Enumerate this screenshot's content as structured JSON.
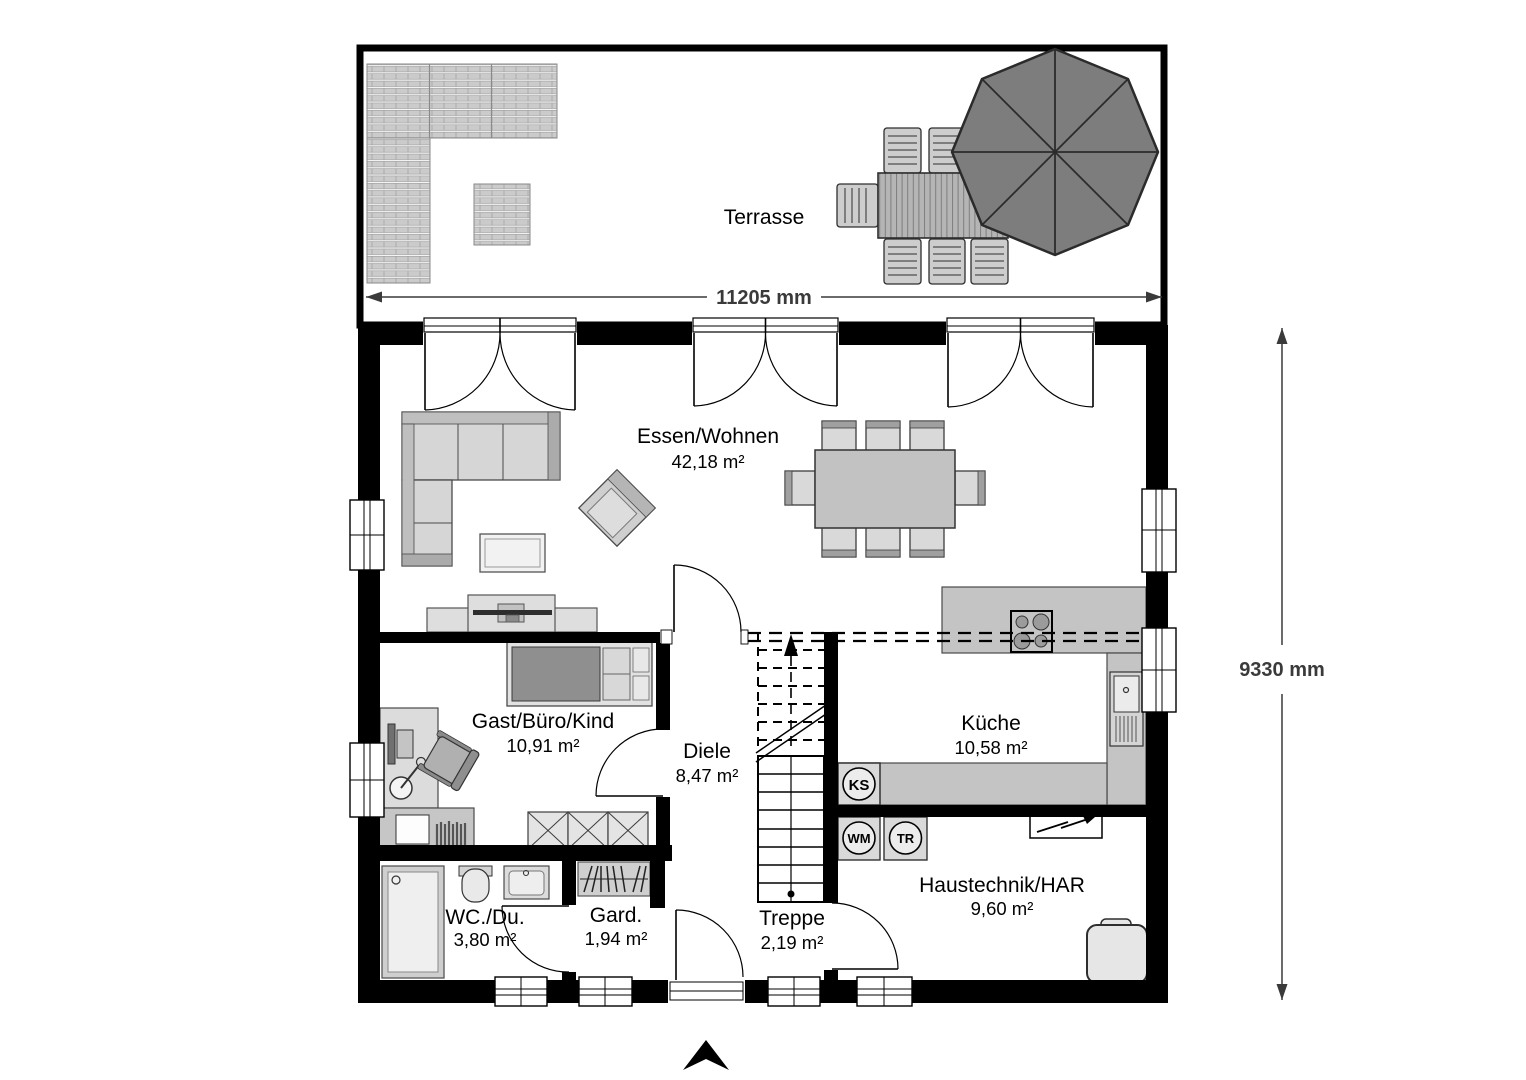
{
  "terrace": {
    "label": "Terrasse"
  },
  "dimensions": {
    "width_label": "11205 mm",
    "height_label": "9330 mm"
  },
  "rooms": {
    "essen_wohnen": {
      "name": "Essen/Wohnen",
      "area": "42,18 m²"
    },
    "gast_buero_kind": {
      "name": "Gast/Büro/Kind",
      "area": "10,91 m²"
    },
    "diele": {
      "name": "Diele",
      "area": "8,47 m²"
    },
    "kueche": {
      "name": "Küche",
      "area": "10,58 m²"
    },
    "wc_du": {
      "name": "WC./Du.",
      "area": "3,80 m²"
    },
    "garderobe": {
      "name": "Gard.",
      "area": "1,94 m²"
    },
    "treppe": {
      "name": "Treppe",
      "area": "2,19 m²"
    },
    "haustechnik": {
      "name": "Haustechnik/HAR",
      "area": "9,60 m²"
    }
  },
  "appliances": {
    "ks": "KS",
    "wm": "WM",
    "tr": "TR"
  },
  "colors": {
    "wall": "#000000",
    "dim": "#3a3a3a",
    "furn_light": "#d6d6d6",
    "furn_mid": "#b5b5b5",
    "furn_dark": "#8f8f8f",
    "counter": "#c4c4c4",
    "umbrella": "#7d7d7d",
    "deck": "#cbcbcb"
  }
}
